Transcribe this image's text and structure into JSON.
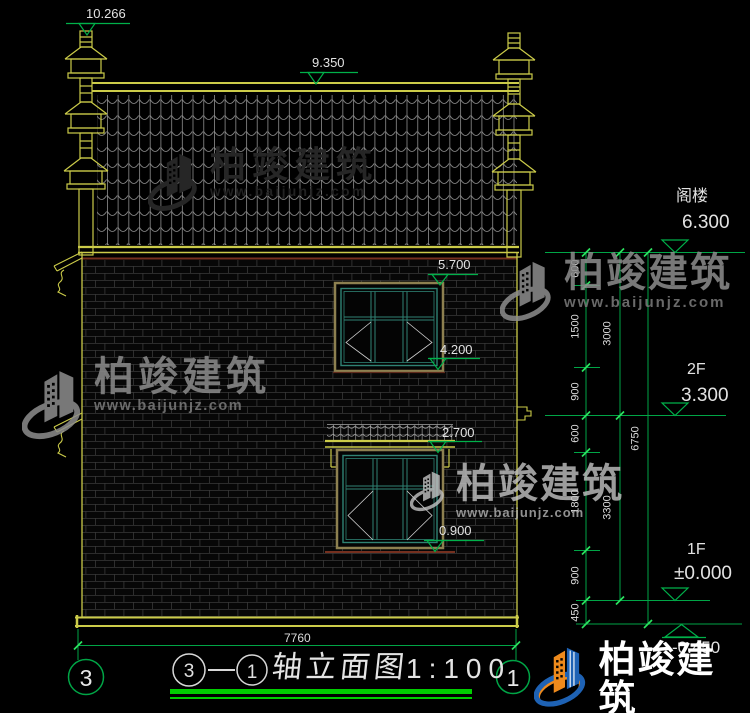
{
  "drawing": {
    "markers": {
      "ornament_top": "10.266",
      "ridge": "9.350",
      "upper_window_head": "5.700",
      "upper_window_sill": "4.200",
      "canopy_level": "2.700",
      "lower_window_sill": "0.900"
    },
    "levels": {
      "attic_label": "阁楼",
      "attic_value": "6.300",
      "f2_label": "2F",
      "f2_value": "3.300",
      "f1_label": "1F",
      "f1_value": "±0.000",
      "base_value": "-0.450"
    },
    "dims": {
      "inner": [
        "600",
        "1500",
        "900",
        "600",
        "1800",
        "900",
        "450"
      ],
      "mid": [
        "3000",
        "3300"
      ],
      "outer": "6750",
      "bottom": "7760"
    },
    "axis": {
      "left": "3",
      "right": "1"
    },
    "title": {
      "bubble_left": "3",
      "bubble_right": "1",
      "name": "轴立面图",
      "scale": "1:100"
    }
  },
  "watermark": {
    "brand": "柏竣建筑",
    "url": "www.baijunjz.com"
  },
  "colors": {
    "background": "#000000",
    "cad_yellow": "#cbcb49",
    "dim_green": "#00a546",
    "tick_green": "#2be35f",
    "underline_green": "#00ce00",
    "window_teal": "#2f8273",
    "frame_tan": "#8d8050",
    "sill_maroon": "#75301f",
    "text_white": "#e2e2e2",
    "logo_orange": "#ee8a1c",
    "logo_blue": "#1e62b4"
  }
}
